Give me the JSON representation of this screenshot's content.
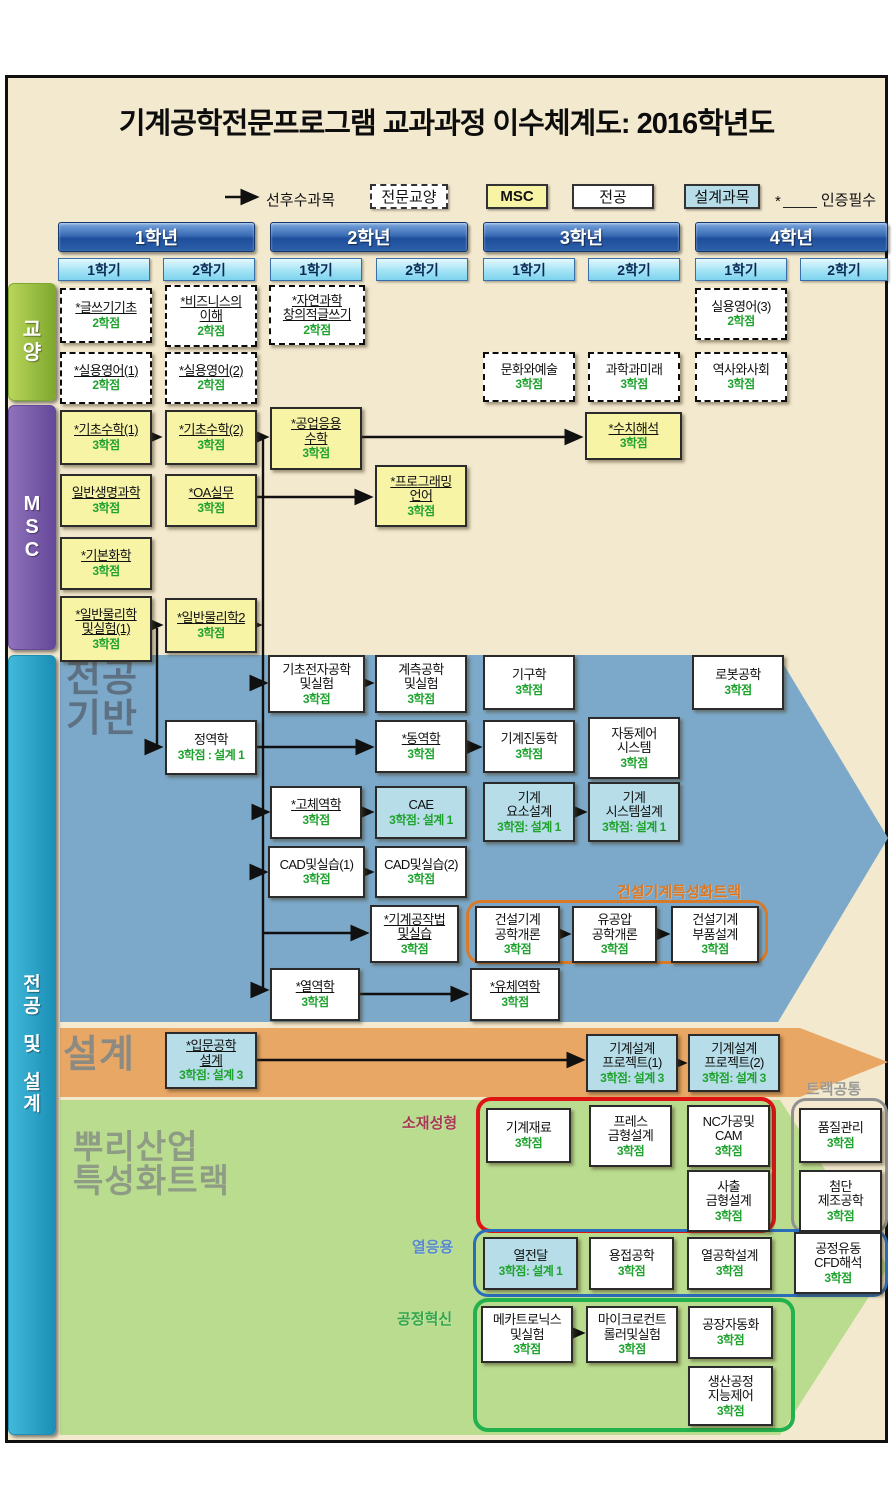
{
  "title": "기계공학전문프로그램 교과과정 이수체계도: 2016학년도",
  "legend": {
    "arrow_label": "선후수과목",
    "boxes": [
      {
        "label": "전문교양",
        "k": "ge",
        "x": 370,
        "w": 78
      },
      {
        "label": "MSC",
        "k": "msc",
        "x": 486,
        "w": 62
      },
      {
        "label": "전공",
        "k": "major",
        "x": 572,
        "w": 82
      },
      {
        "label": "설계과목",
        "k": "design",
        "x": 684,
        "w": 76
      }
    ],
    "star": "*",
    "star_label": "인증필수"
  },
  "years": [
    {
      "label": "1학년",
      "semesters": [
        "1학기",
        "2학기"
      ]
    },
    {
      "label": "2학년",
      "semesters": [
        "1학기",
        "2학기"
      ]
    },
    {
      "label": "3학년",
      "semesters": [
        "1학기",
        "2학기"
      ]
    },
    {
      "label": "4학년",
      "semesters": [
        "1학기",
        "2학기"
      ]
    }
  ],
  "sidebars": [
    {
      "id": "ge",
      "lines": [
        "교",
        "양"
      ],
      "y": 283,
      "h": 118,
      "g1": "#b8d65a",
      "g2": "#7fa82e",
      "fs": 20
    },
    {
      "id": "msc",
      "lines": [
        "M",
        "S",
        "C"
      ],
      "y": 405,
      "h": 245,
      "g1": "#8f72ba",
      "g2": "#66489a",
      "fs": 20
    },
    {
      "id": "major",
      "lines": [
        "전",
        "공",
        "",
        "및",
        "",
        "설",
        "계"
      ],
      "y": 655,
      "h": 780,
      "g1": "#41b9da",
      "g2": "#1b8fb6",
      "fs": 19
    }
  ],
  "section_labels": [
    {
      "text": "전공\n기반",
      "x": 66,
      "y": 660,
      "size": 38,
      "color": "#5d7183"
    },
    {
      "text": "설계",
      "x": 63,
      "y": 1036,
      "size": 38,
      "color": "#8b8b83"
    },
    {
      "text": "뿌리산업\n특성화트랙",
      "x": 73,
      "y": 1130,
      "size": 33,
      "color": "#8e9c85"
    }
  ],
  "track_groups": [
    {
      "label": "건설기계특성화트랙",
      "x": 466,
      "y": 900,
      "w": 302,
      "h": 64,
      "bw": 3.5,
      "border": "#d97a28",
      "lx": 617,
      "ly": 881,
      "lcolor": "#e0761c"
    },
    {
      "label": "트랙공통",
      "x": 791,
      "y": 1098,
      "w": 97,
      "h": 136,
      "bw": 3,
      "border": "#909090",
      "lx": 806,
      "ly": 1078,
      "lcolor": "#9a9a92"
    },
    {
      "label": "소재성형",
      "x": 476,
      "y": 1097,
      "w": 300,
      "h": 136,
      "bw": 4,
      "border": "#de1414",
      "lx": 402,
      "ly": 1112,
      "lcolor": "#a63a55"
    },
    {
      "label": "열응용",
      "x": 473,
      "y": 1229,
      "w": 415,
      "h": 68,
      "bw": 3.5,
      "border": "#2a6ebb",
      "lx": 412,
      "ly": 1236,
      "lcolor": "#5588cc"
    },
    {
      "label": "공정혁신",
      "x": 473,
      "y": 1298,
      "w": 322,
      "h": 134,
      "bw": 4,
      "border": "#22b14c",
      "lx": 397,
      "ly": 1308,
      "lcolor": "#33a64c"
    }
  ],
  "courses": [
    {
      "t": "*글쓰기기초",
      "c": "2학점",
      "k": "ge",
      "u": 1,
      "x": 60,
      "y": 288,
      "w": 92,
      "h": 55
    },
    {
      "t": "*비즈니스의\n이해",
      "c": "2학점",
      "k": "ge",
      "u": 1,
      "x": 165,
      "y": 285,
      "w": 92,
      "h": 62
    },
    {
      "t": "*자연과학\n창의적글쓰기",
      "c": "2학점",
      "k": "ge",
      "u": 1,
      "x": 269,
      "y": 285,
      "w": 96,
      "h": 60
    },
    {
      "t": "*실용영어(1)",
      "c": "2학점",
      "k": "ge",
      "u": 1,
      "x": 60,
      "y": 352,
      "w": 92,
      "h": 52
    },
    {
      "t": "*실용영어(2)",
      "c": "2학점",
      "k": "ge",
      "u": 1,
      "x": 165,
      "y": 352,
      "w": 92,
      "h": 52
    },
    {
      "t": "실용영어(3)",
      "c": "2학점",
      "k": "ge",
      "u": 0,
      "x": 695,
      "y": 288,
      "w": 92,
      "h": 52
    },
    {
      "t": "문화와예술",
      "c": "3학점",
      "k": "ge",
      "u": 0,
      "x": 483,
      "y": 352,
      "w": 92,
      "h": 50
    },
    {
      "t": "과학과미래",
      "c": "3학점",
      "k": "ge",
      "u": 0,
      "x": 588,
      "y": 352,
      "w": 92,
      "h": 50
    },
    {
      "t": "역사와사회",
      "c": "3학점",
      "k": "ge",
      "u": 0,
      "x": 695,
      "y": 352,
      "w": 92,
      "h": 50
    },
    {
      "t": "*기초수학(1)",
      "c": "3학점",
      "k": "msc",
      "u": 1,
      "x": 60,
      "y": 410,
      "w": 92,
      "h": 55
    },
    {
      "t": "*기초수학(2)",
      "c": "3학점",
      "k": "msc",
      "u": 1,
      "x": 165,
      "y": 410,
      "w": 92,
      "h": 55
    },
    {
      "t": "*공업응용\n수학",
      "c": "3학점",
      "k": "msc",
      "u": 1,
      "x": 270,
      "y": 407,
      "w": 92,
      "h": 63
    },
    {
      "t": "*수치해석",
      "c": "3학점",
      "k": "msc",
      "u": 1,
      "x": 585,
      "y": 412,
      "w": 97,
      "h": 48
    },
    {
      "t": "일반생명과학",
      "c": "3학점",
      "k": "msc",
      "u": 1,
      "x": 60,
      "y": 474,
      "w": 92,
      "h": 53
    },
    {
      "t": "*OA실무",
      "c": "3학점",
      "k": "msc",
      "u": 1,
      "x": 165,
      "y": 474,
      "w": 92,
      "h": 53
    },
    {
      "t": "*프로그래밍\n언어",
      "c": "3학점",
      "k": "msc",
      "u": 1,
      "x": 375,
      "y": 465,
      "w": 92,
      "h": 62
    },
    {
      "t": "*기본화학",
      "c": "3학점",
      "k": "msc",
      "u": 1,
      "x": 60,
      "y": 537,
      "w": 92,
      "h": 53
    },
    {
      "t": "*일반물리학\n및실험(1)",
      "c": "3학점",
      "k": "msc",
      "u": 1,
      "x": 60,
      "y": 596,
      "w": 92,
      "h": 66
    },
    {
      "t": "*일반물리학2",
      "c": "3학점",
      "k": "msc",
      "u": 1,
      "x": 165,
      "y": 598,
      "w": 92,
      "h": 55
    },
    {
      "t": "정역학",
      "c": "3학점 : 설계 1",
      "k": "major",
      "u": 0,
      "x": 165,
      "y": 720,
      "w": 92,
      "h": 55
    },
    {
      "t": "기초전자공학\n및실험",
      "c": "3학점",
      "k": "major",
      "u": 0,
      "x": 268,
      "y": 655,
      "w": 97,
      "h": 58
    },
    {
      "t": "계측공학\n및실험",
      "c": "3학점",
      "k": "major",
      "u": 0,
      "x": 375,
      "y": 655,
      "w": 92,
      "h": 58
    },
    {
      "t": "기구학",
      "c": "3학점",
      "k": "major",
      "u": 0,
      "x": 483,
      "y": 655,
      "w": 92,
      "h": 55
    },
    {
      "t": "로봇공학",
      "c": "3학점",
      "k": "major",
      "u": 0,
      "x": 692,
      "y": 655,
      "w": 92,
      "h": 55
    },
    {
      "t": "*동역학",
      "c": "3학점",
      "k": "major",
      "u": 1,
      "x": 375,
      "y": 720,
      "w": 92,
      "h": 53
    },
    {
      "t": "기계진동학",
      "c": "3학점",
      "k": "major",
      "u": 0,
      "x": 483,
      "y": 720,
      "w": 92,
      "h": 53
    },
    {
      "t": "자동제어\n시스템",
      "c": "3학점",
      "k": "major",
      "u": 0,
      "x": 588,
      "y": 717,
      "w": 92,
      "h": 62
    },
    {
      "t": "*고체역학",
      "c": "3학점",
      "k": "major",
      "u": 1,
      "x": 270,
      "y": 786,
      "w": 92,
      "h": 53
    },
    {
      "t": "CAE",
      "c": "3학점: 설계 1",
      "k": "design",
      "u": 0,
      "x": 375,
      "y": 786,
      "w": 92,
      "h": 53
    },
    {
      "t": "기계\n요소설계",
      "c": "3학점: 설계 1",
      "k": "design",
      "u": 0,
      "x": 483,
      "y": 782,
      "w": 92,
      "h": 60
    },
    {
      "t": "기계\n시스템설계",
      "c": "3학점: 설계 1",
      "k": "design",
      "u": 0,
      "x": 588,
      "y": 782,
      "w": 92,
      "h": 60
    },
    {
      "t": "CAD및실습(1)",
      "c": "3학점",
      "k": "major",
      "u": 0,
      "x": 268,
      "y": 846,
      "w": 97,
      "h": 52
    },
    {
      "t": "CAD및실습(2)",
      "c": "3학점",
      "k": "major",
      "u": 0,
      "x": 375,
      "y": 846,
      "w": 92,
      "h": 52
    },
    {
      "t": "*기계공작법\n및실습",
      "c": "3학점",
      "k": "major",
      "u": 1,
      "x": 370,
      "y": 905,
      "w": 89,
      "h": 58
    },
    {
      "t": "건설기계\n공학개론",
      "c": "3학점",
      "k": "major",
      "u": 0,
      "x": 475,
      "y": 906,
      "w": 85,
      "h": 57
    },
    {
      "t": "유공압\n공학개론",
      "c": "3학점",
      "k": "major",
      "u": 0,
      "x": 572,
      "y": 906,
      "w": 85,
      "h": 57
    },
    {
      "t": "건설기계\n부품설계",
      "c": "3학점",
      "k": "major",
      "u": 0,
      "x": 671,
      "y": 906,
      "w": 88,
      "h": 57
    },
    {
      "t": "*열역학",
      "c": "3학점",
      "k": "major",
      "u": 1,
      "x": 270,
      "y": 968,
      "w": 90,
      "h": 53
    },
    {
      "t": "*유체역학",
      "c": "3학점",
      "k": "major",
      "u": 1,
      "x": 470,
      "y": 968,
      "w": 90,
      "h": 53
    },
    {
      "t": "*입문공학\n설계",
      "c": "3학점: 설계 3",
      "k": "design",
      "u": 1,
      "x": 165,
      "y": 1032,
      "w": 92,
      "h": 57
    },
    {
      "t": "기계설계\n프로젝트(1)",
      "c": "3학점: 설계 3",
      "k": "design",
      "u": 0,
      "x": 586,
      "y": 1034,
      "w": 92,
      "h": 58
    },
    {
      "t": "기계설계\n프로젝트(2)",
      "c": "3학점: 설계 3",
      "k": "design",
      "u": 0,
      "x": 688,
      "y": 1034,
      "w": 92,
      "h": 58
    },
    {
      "t": "기계재료",
      "c": "3학점",
      "k": "major",
      "u": 0,
      "x": 486,
      "y": 1108,
      "w": 85,
      "h": 55
    },
    {
      "t": "프레스\n금형설계",
      "c": "3학점",
      "k": "major",
      "u": 0,
      "x": 589,
      "y": 1105,
      "w": 83,
      "h": 62
    },
    {
      "t": "NC가공및\nCAM",
      "c": "3학점",
      "k": "major",
      "u": 0,
      "x": 687,
      "y": 1105,
      "w": 83,
      "h": 62
    },
    {
      "t": "사출\n금형설계",
      "c": "3학점",
      "k": "major",
      "u": 0,
      "x": 687,
      "y": 1170,
      "w": 83,
      "h": 62
    },
    {
      "t": "품질관리",
      "c": "3학점",
      "k": "major",
      "u": 0,
      "x": 799,
      "y": 1108,
      "w": 83,
      "h": 55
    },
    {
      "t": "첨단\n제조공학",
      "c": "3학점",
      "k": "major",
      "u": 0,
      "x": 799,
      "y": 1170,
      "w": 83,
      "h": 62
    },
    {
      "t": "열전달",
      "c": "3학점: 설계 1",
      "k": "design",
      "u": 0,
      "x": 483,
      "y": 1237,
      "w": 95,
      "h": 53
    },
    {
      "t": "용접공학",
      "c": "3학점",
      "k": "major",
      "u": 0,
      "x": 589,
      "y": 1237,
      "w": 85,
      "h": 53
    },
    {
      "t": "열공학설계",
      "c": "3학점",
      "k": "major",
      "u": 0,
      "x": 687,
      "y": 1237,
      "w": 85,
      "h": 53
    },
    {
      "t": "공정유동\nCFD해석",
      "c": "3학점",
      "k": "major",
      "u": 0,
      "x": 794,
      "y": 1232,
      "w": 88,
      "h": 62
    },
    {
      "t": "메카트로닉스\n및실험",
      "c": "3학점",
      "k": "major",
      "u": 0,
      "x": 481,
      "y": 1306,
      "w": 92,
      "h": 57
    },
    {
      "t": "마이크로컨트\n롤러및실험",
      "c": "3학점",
      "k": "major",
      "u": 0,
      "x": 586,
      "y": 1306,
      "w": 92,
      "h": 57
    },
    {
      "t": "공장자동화",
      "c": "3학점",
      "k": "major",
      "u": 0,
      "x": 688,
      "y": 1306,
      "w": 85,
      "h": 53
    },
    {
      "t": "생산공정\n지능제어",
      "c": "3학점",
      "k": "major",
      "u": 0,
      "x": 688,
      "y": 1366,
      "w": 85,
      "h": 60
    }
  ],
  "colors": {
    "background": "#f3e9cf",
    "year_header": "#2d5fa9",
    "semester": "#a4e3f5",
    "msc_box": "#f8f4a6",
    "design_box": "#b6dde8",
    "credit_text": "#1fa32e",
    "major_band": "#7ca9c9",
    "design_band": "#e9a765",
    "track_band": "#b9dc8e"
  }
}
